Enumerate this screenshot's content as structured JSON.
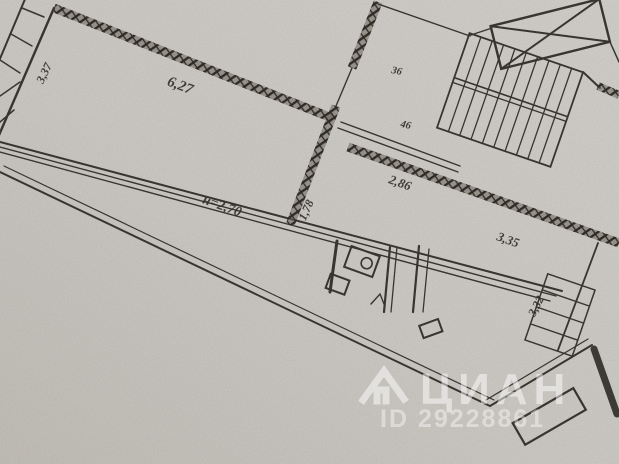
{
  "floor_plan": {
    "dimensions": {
      "left_balcony": "3,37",
      "main_room_width": "6,27",
      "ceiling_height": "н=2,70",
      "hallway_width": "1,78",
      "hall_wall": "2,86",
      "right_room_width": "3,35",
      "right_balcony": "3,32",
      "note_upper": "36",
      "note_lower": "46"
    },
    "watermark": {
      "brand": "ЦИАН",
      "listing_id": "ID 29228861"
    }
  }
}
